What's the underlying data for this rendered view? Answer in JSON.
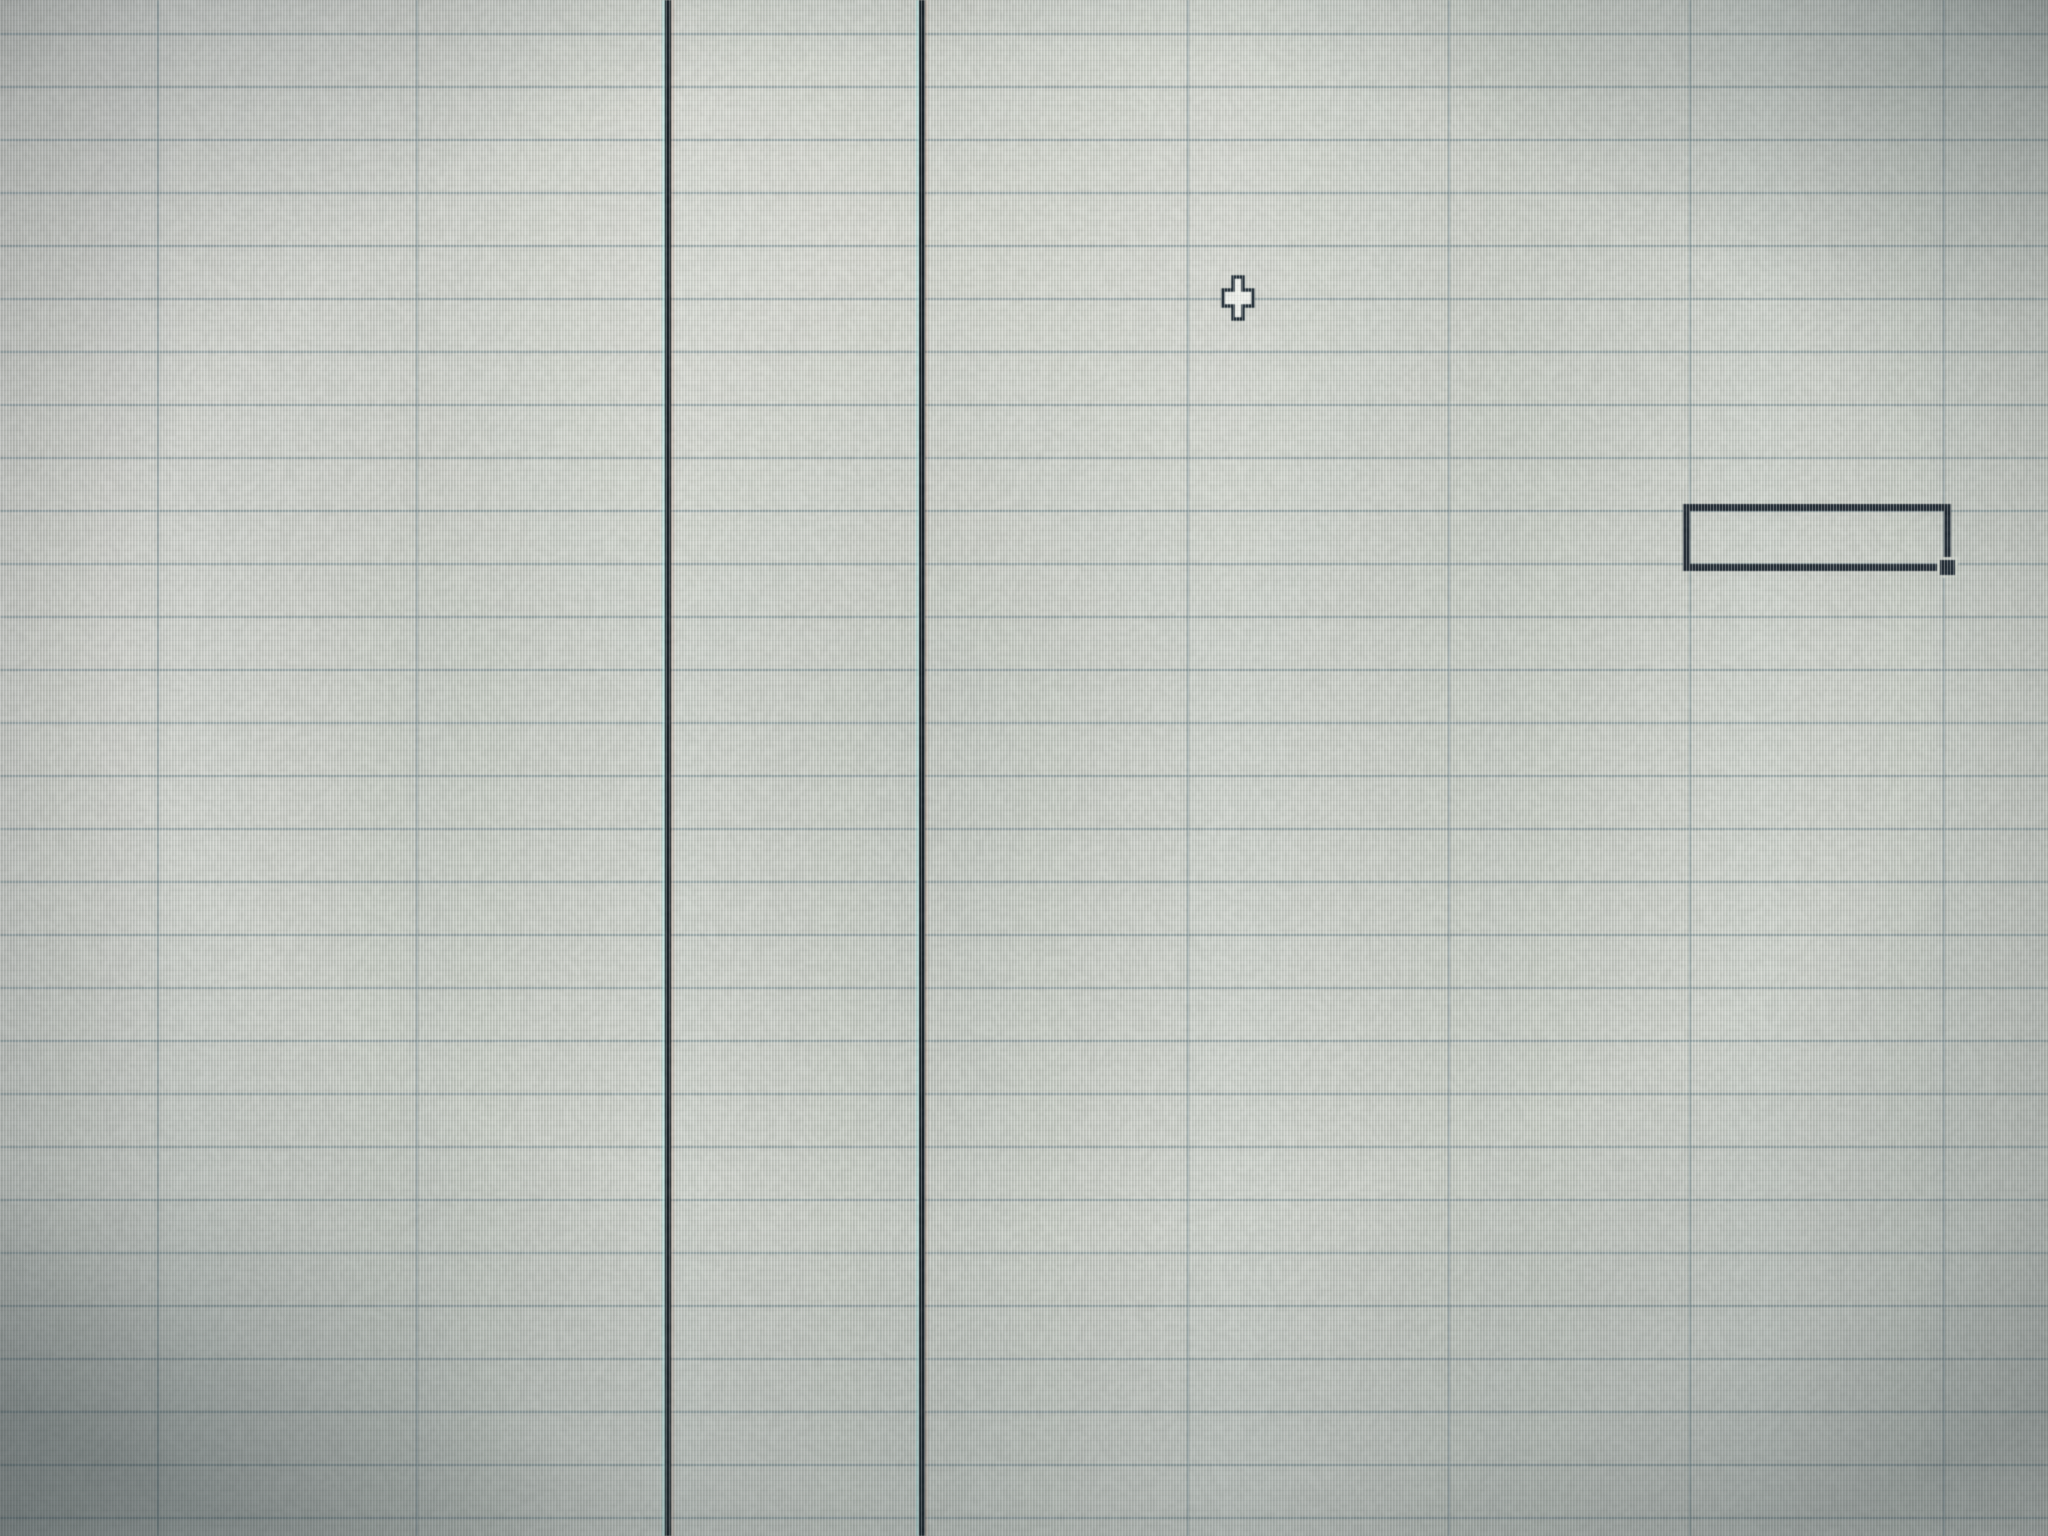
{
  "screen": {
    "kind": "spreadsheet-grid-photo",
    "width": 2048,
    "height": 1536,
    "visible_text": "none",
    "colors": {
      "background_base": "#cbd0c8",
      "gridline": "rgba(104,128,136,0.55)",
      "page_break_line": "#0d161c",
      "selection_border": "#1a242e",
      "cursor_fill": "#f3f6f0",
      "cursor_outline": "#1d2a33"
    }
  },
  "grid": {
    "row_line_ys": [
      34,
      87,
      140,
      193,
      246,
      299,
      352,
      405,
      458,
      511,
      564,
      617,
      670,
      723,
      776,
      829,
      882,
      935,
      988,
      1041,
      1094,
      1147,
      1200,
      1253,
      1306,
      1359,
      1412,
      1465,
      1518
    ],
    "column_line_xs": [
      158,
      417,
      1188,
      1449,
      1690,
      1944
    ],
    "line_thickness": 2,
    "row_height": 53,
    "column_width": 255
  },
  "page_breaks": {
    "xs": [
      668,
      922
    ],
    "thickness": 6
  },
  "selection": {
    "left": 1683,
    "top": 504,
    "width": 268,
    "height": 67,
    "border_width": 7,
    "cell_value": "",
    "fill_handle": true
  },
  "cursor": {
    "shape": "cell-plus",
    "left": 1221,
    "top": 275,
    "width": 34,
    "height": 46
  }
}
